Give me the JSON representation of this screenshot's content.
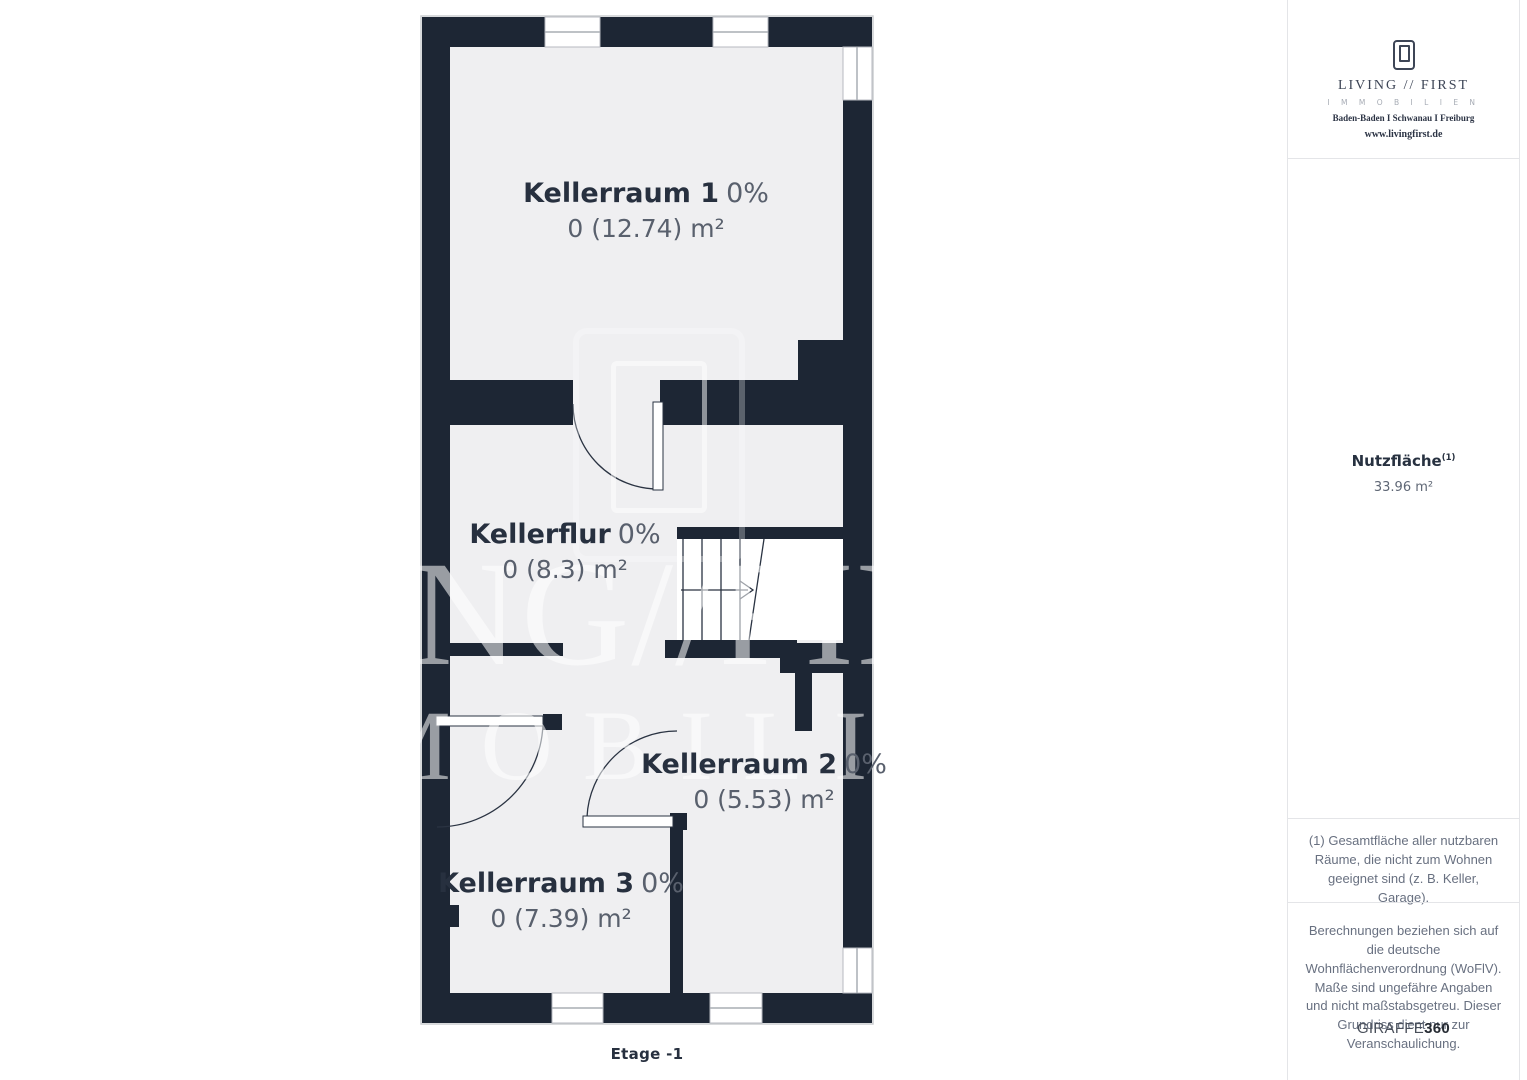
{
  "plan": {
    "rooms": [
      {
        "name": "Kellerraum 1",
        "pct": "0%",
        "area": "0 (12.74) m²"
      },
      {
        "name": "Kellerflur",
        "pct": "0%",
        "area": "0 (8.3) m²"
      },
      {
        "name": "Kellerraum 2",
        "pct": "0%",
        "area": "0 (5.53) m²"
      },
      {
        "name": "Kellerraum 3",
        "pct": "0%",
        "area": "0 (7.39) m²"
      }
    ],
    "floor_label": "Etage -1",
    "colors": {
      "wall": "#1d2634",
      "room_fill": "#efeff1",
      "stairwell_fill": "#ffffff",
      "label_text": "#27303f",
      "muted_text": "#59606d"
    }
  },
  "watermark": {
    "line1": "LIVING//FIRST",
    "line2": "IMMOBILIEN"
  },
  "sidebar": {
    "logo": {
      "name_line": "LIVING // FIRST",
      "sub_line": "I M M O B I L I E N",
      "cities": "Baden-Baden I Schwanau I Freiburg",
      "website": "www.livingfirst.de"
    },
    "metric": {
      "label": "Nutzfläche",
      "superscript": "(1)",
      "value": "33.96 m²"
    },
    "footnote": "(1) Gesamtfläche aller nutzbaren Räume, die nicht zum Wohnen geeignet sind (z. B. Keller, Garage).",
    "disclaimer": "Berechnungen beziehen sich auf die deutsche Wohnflächenverordnung (WoFlV). Maße sind ungefähre Angaben und nicht maßstabsgetreu. Dieser Grundriss dient nur zur Veranschaulichung.",
    "brand": {
      "name": "GIRAFFE",
      "suffix": "360"
    }
  }
}
